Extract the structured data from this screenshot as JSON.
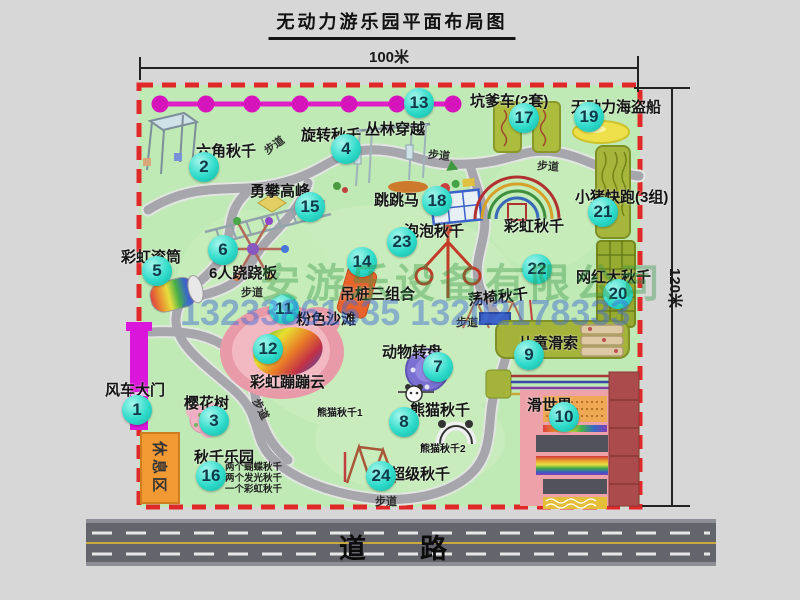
{
  "title": "无动力游乐园平面布局图",
  "dimensions": {
    "top": "100米",
    "right": "120米"
  },
  "road_label": "道　　路",
  "watermark": {
    "company": "安游乐设备有限公司",
    "phones": "13233861635 13202178333"
  },
  "rest_area_label": "休息区",
  "path_label_text": "步道",
  "swing_park_notes": [
    "两个蝴蝶秋千",
    "两个发光秋千",
    "一个彩虹秋千"
  ],
  "attractions": [
    {
      "num": "1",
      "name": "风车大门",
      "label": [
        105,
        379
      ],
      "badge": [
        137,
        410
      ]
    },
    {
      "num": "2",
      "name": "六角秋千",
      "label": [
        196,
        140
      ],
      "badge": [
        204,
        167
      ]
    },
    {
      "num": "3",
      "name": "樱花树",
      "label": [
        184,
        392
      ],
      "badge": [
        214,
        421
      ]
    },
    {
      "num": "4",
      "name": "旋转秋千",
      "label": [
        301,
        124
      ],
      "badge": [
        346,
        149
      ]
    },
    {
      "num": "5",
      "name": "彩虹滚筒",
      "label": [
        121,
        246
      ],
      "badge": [
        157,
        271
      ]
    },
    {
      "num": "6",
      "name": "6人跷跷板",
      "label": [
        209,
        262
      ],
      "badge": [
        223,
        250
      ]
    },
    {
      "num": "7",
      "name": "动物转盘",
      "label": [
        382,
        341
      ],
      "badge": [
        438,
        367
      ]
    },
    {
      "num": "8",
      "name": "熊猫秋千",
      "label": [
        410,
        399
      ],
      "badge": [
        404,
        422
      ]
    },
    {
      "num": "9",
      "name": "儿童滑索",
      "label": [
        518,
        332
      ],
      "badge": [
        529,
        355
      ]
    },
    {
      "num": "10",
      "name": "滑世界",
      "label": [
        527,
        394
      ],
      "badge": [
        564,
        417
      ]
    },
    {
      "num": "11",
      "name": "粉色沙滩",
      "label": [
        296,
        308
      ],
      "badge": [
        284,
        309
      ]
    },
    {
      "num": "12",
      "name": "彩虹蹦蹦云",
      "label": [
        250,
        371
      ],
      "badge": [
        268,
        349
      ]
    },
    {
      "num": "13",
      "name": "丛林穿越",
      "label": [
        365,
        118
      ],
      "badge": [
        419,
        103
      ]
    },
    {
      "num": "14",
      "name": "吊桩三组合",
      "label": [
        340,
        283
      ],
      "badge": [
        362,
        262
      ]
    },
    {
      "num": "15",
      "name": "勇攀高峰",
      "label": [
        250,
        180
      ],
      "badge": [
        310,
        207
      ]
    },
    {
      "num": "16",
      "name": "秋千乐园",
      "label": [
        194,
        446
      ],
      "badge": [
        211,
        476
      ]
    },
    {
      "num": "17",
      "name": "坑爹车(2套)",
      "label": [
        470,
        90
      ],
      "badge": [
        524,
        118
      ]
    },
    {
      "num": "18",
      "name": "跳跳马",
      "label": [
        374,
        189
      ],
      "badge": [
        437,
        201
      ]
    },
    {
      "num": "19",
      "name": "无动力海盗船",
      "label": [
        571,
        96
      ],
      "badge": [
        589,
        117
      ]
    },
    {
      "num": "20",
      "name": "网红大秋千",
      "label": [
        576,
        266
      ],
      "badge": [
        618,
        294
      ]
    },
    {
      "num": "21",
      "name": "小猪快跑(3组)",
      "label": [
        575,
        186
      ],
      "badge": [
        603,
        212
      ]
    },
    {
      "num": "22",
      "name": "荡椅秋千",
      "label": [
        468,
        286
      ],
      "badge": [
        537,
        269
      ],
      "rot": -6
    },
    {
      "num": "23",
      "name": "泡泡秋千",
      "label": [
        404,
        220
      ],
      "badge": [
        402,
        242
      ]
    },
    {
      "num": "24",
      "name": "超级秋千",
      "label": [
        390,
        463
      ],
      "badge": [
        381,
        476
      ]
    }
  ],
  "extra_labels": [
    {
      "text": "彩虹秋千",
      "x": 504,
      "y": 215,
      "size": 15
    },
    {
      "text": "熊猫秋千1",
      "x": 317,
      "y": 404,
      "size": 10
    },
    {
      "text": "熊猫秋千2",
      "x": 420,
      "y": 440,
      "size": 10
    }
  ],
  "path_labels": [
    {
      "x": 263,
      "y": 137,
      "rot": -36
    },
    {
      "x": 428,
      "y": 147,
      "rot": 6
    },
    {
      "x": 537,
      "y": 158,
      "rot": 4
    },
    {
      "x": 241,
      "y": 284,
      "rot": 0
    },
    {
      "x": 456,
      "y": 314,
      "rot": 0
    },
    {
      "x": 250,
      "y": 401,
      "rot": 62
    },
    {
      "x": 375,
      "y": 493,
      "rot": 0
    }
  ],
  "colors": {
    "map_green": "#bfe9b5",
    "boundary_red": "#e02828",
    "badge_teal": "#2edbca",
    "gate_magenta": "#da16da",
    "chain_magenta": "#d614bc",
    "road_gray": "#64646c",
    "rest_area_orange": "#f19a34"
  }
}
